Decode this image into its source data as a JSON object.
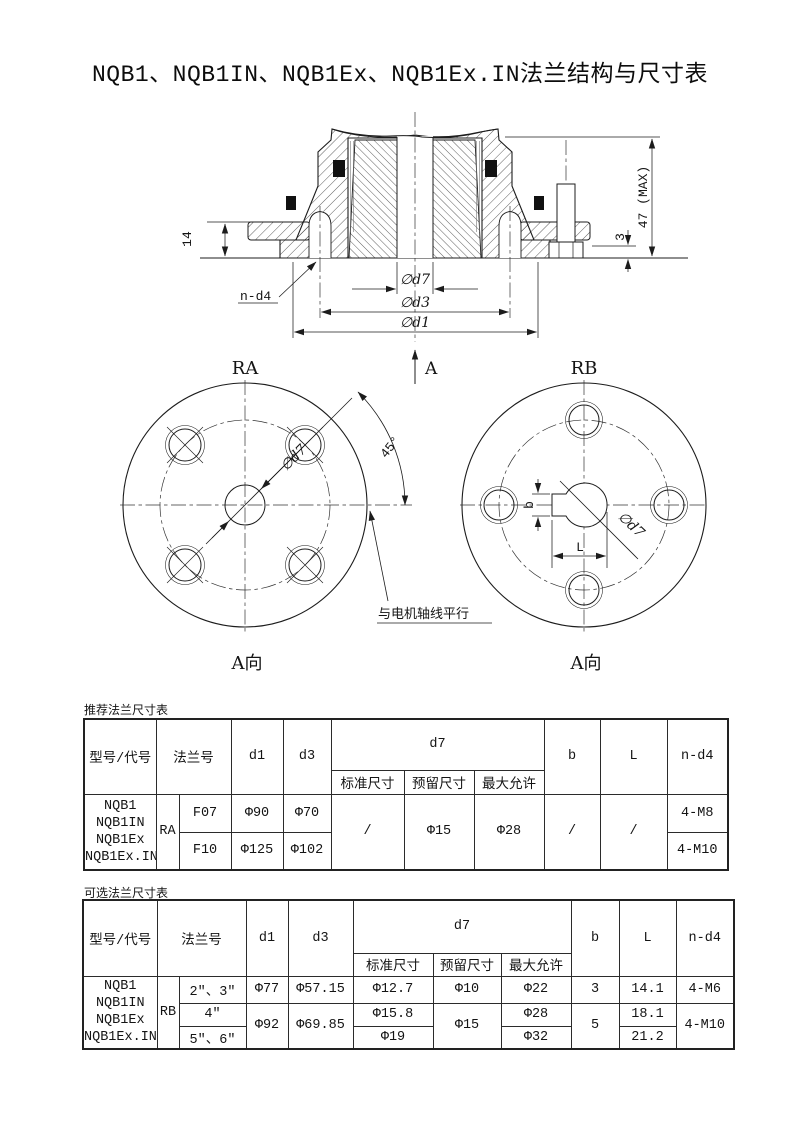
{
  "title": "NQB1、NQB1IN、NQB1Ex、NQB1Ex.IN法兰结构与尺寸表",
  "drawing": {
    "dim14": "14",
    "dim47": "47 (MAX)",
    "dim3": "3",
    "nd4": "n-d4",
    "phid7": "∅d7",
    "phid3": "∅d3",
    "phid1": "∅d1",
    "arrowA": "A",
    "ra": {
      "label": "RA",
      "dir": "A向",
      "angle": "45°",
      "phid7": "∅d7",
      "note": "与电机轴线平行"
    },
    "rb": {
      "label": "RB",
      "dir": "A向",
      "b": "b",
      "L": "L",
      "phid7": "∅d7"
    }
  },
  "table1": {
    "caption": "推荐法兰尺寸表",
    "col_model": "型号/代号",
    "col_flange": "法兰号",
    "col_d1": "d1",
    "col_d3": "d3",
    "col_d7": "d7",
    "col_std": "标准尺寸",
    "col_res": "预留尺寸",
    "col_max": "最大允许",
    "col_b": "b",
    "col_L": "L",
    "col_nd4": "n-d4",
    "model": "NQB1\nNQB1IN\nNQB1Ex\nNQB1Ex.IN",
    "code": "RA",
    "r1": {
      "no": "F07",
      "d1": "Φ90",
      "d3": "Φ70",
      "nd4": "4-M8"
    },
    "r2": {
      "no": "F10",
      "d1": "Φ125",
      "d3": "Φ102",
      "nd4": "4-M10"
    },
    "d7std": "/",
    "d7res": "Φ15",
    "d7max": "Φ28",
    "b": "/",
    "L": "/"
  },
  "table2": {
    "caption": "可选法兰尺寸表",
    "col_model": "型号/代号",
    "col_flange": "法兰号",
    "col_d1": "d1",
    "col_d3": "d3",
    "col_d7": "d7",
    "col_std": "标准尺寸",
    "col_res": "预留尺寸",
    "col_max": "最大允许",
    "col_b": "b",
    "col_L": "L",
    "col_nd4": "n-d4",
    "model": "NQB1\nNQB1IN\nNQB1Ex\nNQB1Ex.IN",
    "code": "RB",
    "r1": {
      "no": "2\"、3\"",
      "d1": "Φ77",
      "d3": "Φ57.15",
      "d7std": "Φ12.7",
      "d7res": "Φ10",
      "d7max": "Φ22",
      "b": "3",
      "L": "14.1",
      "nd4": "4-M6"
    },
    "r2": {
      "no": "4\"",
      "d7std": "Φ15.8",
      "d7max": "Φ28",
      "L": "18.1"
    },
    "r3": {
      "no": "5\"、6\"",
      "d7std": "Φ19",
      "d7max": "Φ32",
      "L": "21.2"
    },
    "merged": {
      "d1": "Φ92",
      "d3": "Φ69.85",
      "d7res": "Φ15",
      "b": "5",
      "nd4": "4-M10"
    }
  }
}
